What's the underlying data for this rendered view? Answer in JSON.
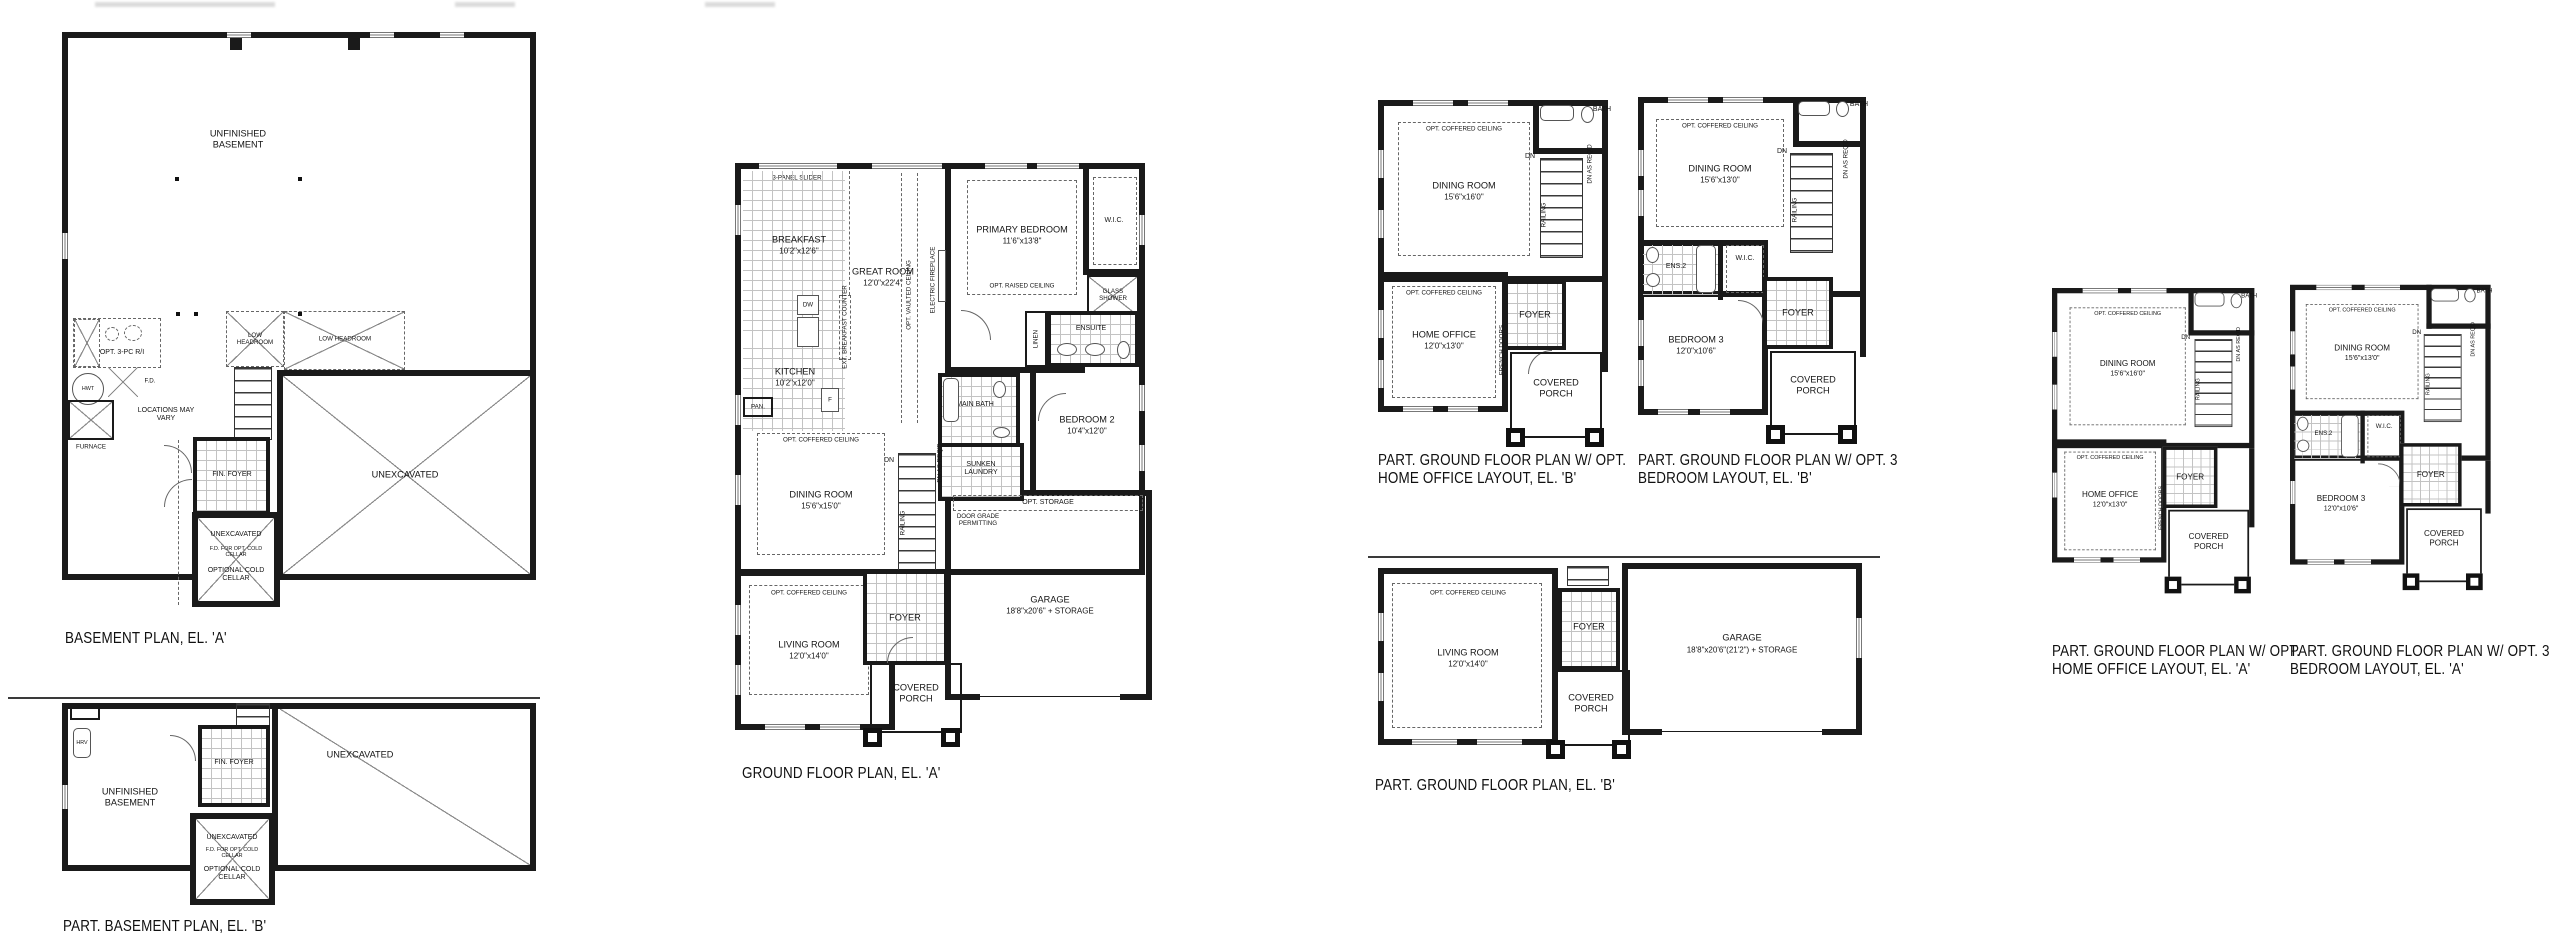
{
  "plans": {
    "basement_a": {
      "title": "BASEMENT PLAN, EL. 'A'",
      "labels": {
        "unfinished_basement": "UNFINISHED BASEMENT",
        "opt_3pc": "OPT. 3-PC R/I",
        "hwt": "HWT",
        "fd": "F.D.",
        "furnace": "FURNACE",
        "locations_vary": "LOCATIONS MAY VARY",
        "low_headroom_a": "LOW HEADROOM",
        "low_headroom_b": "LOW HEADROOM",
        "up": "UP",
        "fin_foyer": "FIN. FOYER",
        "unexcavated": "UNEXCAVATED",
        "cc_unexcavated": "UNEXCAVATED",
        "cc_fd": "F.D. FOR OPT. COLD CELLAR",
        "cold_cellar": "OPTIONAL COLD CELLAR"
      }
    },
    "basement_b": {
      "title": "PART. BASEMENT PLAN, EL. 'B'",
      "labels": {
        "unfinished_basement": "UNFINISHED BASEMENT",
        "hrv": "HRV",
        "fin_foyer": "FIN. FOYER",
        "up": "UP",
        "unexcavated": "UNEXCAVATED",
        "cc_unexcavated": "UNEXCAVATED",
        "cc_fd": "F.D. FOR OPT. COLD CELLAR",
        "cold_cellar": "OPTIONAL COLD CELLAR"
      }
    },
    "ground_a": {
      "title": "GROUND FLOOR PLAN, EL. 'A'",
      "labels": {
        "slider": "3-PANEL SLIDER",
        "breakfast": "BREAKFAST",
        "breakfast_dim": "10'2\"x12'6\"",
        "great_room": "GREAT ROOM",
        "great_room_dim": "12'0\"x22'4\"",
        "opt_vaulted": "OPT. VAULTED CEILING",
        "electric_fireplace": "ELECTRIC FIREPLACE",
        "primary_bedroom": "PRIMARY BEDROOM",
        "primary_dim": "11'6\"x13'8\"",
        "opt_raised": "OPT. RAISED CEILING",
        "wic": "W.I.C.",
        "glass_shower": "GLASS SHOWER",
        "ensuite": "ENSUITE",
        "linen": "LINEN",
        "kitchen": "KITCHEN",
        "kitchen_dim": "10'2\"x12'0\"",
        "pantry": "PAN.",
        "dw": "DW",
        "fridge": "F",
        "ext_counter": "EXT. BREAKFAST COUNTER",
        "main_bath": "MAIN BATH",
        "sunken_laundry": "SUNKEN LAUNDRY",
        "dn": "DN",
        "railing": "RAILING",
        "dn_as_reqd": "DN AS REQ'D",
        "opt_coffered_dining": "OPT. COFFERED CEILING",
        "dining": "DINING ROOM",
        "dining_dim": "15'6\"x15'0\"",
        "bedroom2": "BEDROOM 2",
        "bedroom2_dim": "10'4\"x12'0\"",
        "door_grade": "DOOR GRADE PERMITTING",
        "opt_storage": "OPT. STORAGE",
        "garage": "GARAGE",
        "garage_dim": "18'8\"x20'6\" + STORAGE",
        "opt_coffered_living": "OPT. COFFERED CEILING",
        "living": "LIVING ROOM",
        "living_dim": "12'0\"x14'0\"",
        "foyer": "FOYER",
        "covered_porch": "COVERED PORCH"
      }
    },
    "part_b_office": {
      "title_line1": "PART. GROUND FLOOR PLAN W/ OPT.",
      "title_line2": "HOME OFFICE LAYOUT, EL. 'B'",
      "labels": {
        "bath": "BATH",
        "opt_coffered_dining": "OPT. COFFERED CEILING",
        "dining": "DINING ROOM",
        "dining_dim": "15'6\"x16'0\"",
        "dn": "DN",
        "railing": "RAILING",
        "dn_as_reqd": "DN AS REQ'D",
        "opt_coffered_office": "OPT. COFFERED CEILING",
        "home_office": "HOME OFFICE",
        "home_office_dim": "12'0\"x13'0\"",
        "french_doors": "FRENCH DOORS",
        "foyer": "FOYER",
        "covered_porch": "COVERED PORCH"
      }
    },
    "part_b_bed3": {
      "title_line1": "PART. GROUND FLOOR PLAN W/ OPT. 3",
      "title_line2": "BEDROOM LAYOUT, EL. 'B'",
      "labels": {
        "bath": "BATH",
        "opt_coffered_dining": "OPT. COFFERED CEILING",
        "dining": "DINING ROOM",
        "dining_dim": "15'6\"x13'0\"",
        "ens2": "ENS.2",
        "wic": "W.I.C.",
        "bedroom3": "BEDROOM 3",
        "bedroom3_dim": "12'0\"x10'6\"",
        "dn": "DN",
        "railing": "RAILING",
        "dn_as_reqd": "DN AS REQ'D",
        "foyer": "FOYER",
        "covered_porch": "COVERED PORCH"
      }
    },
    "part_b_ground": {
      "title": "PART. GROUND FLOOR PLAN, EL. 'B'",
      "labels": {
        "opt_coffered_living": "OPT. COFFERED CEILING",
        "living": "LIVING ROOM",
        "living_dim": "12'0\"x14'0\"",
        "foyer": "FOYER",
        "garage": "GARAGE",
        "garage_dim": "18'8\"x20'6\"(21'2\") + STORAGE",
        "covered_porch": "COVERED PORCH"
      }
    },
    "part_a_office": {
      "title_line1": "PART. GROUND FLOOR PLAN W/ OPT.",
      "title_line2": "HOME OFFICE LAYOUT, EL. 'A'",
      "labels": {
        "bath": "BATH",
        "opt_coffered_dining": "OPT. COFFERED CEILING",
        "dining": "DINING ROOM",
        "dining_dim": "15'6\"x16'0\"",
        "dn": "DN",
        "railing": "RAILING",
        "dn_as_reqd": "DN AS REQ'D",
        "opt_coffered_office": "OPT. COFFERED CEILING",
        "home_office": "HOME OFFICE",
        "home_office_dim": "12'0\"x13'0\"",
        "french_doors": "FRENCH DOORS",
        "foyer": "FOYER",
        "covered_porch": "COVERED PORCH"
      }
    },
    "part_a_bed3": {
      "title_line1": "PART. GROUND FLOOR PLAN W/ OPT. 3",
      "title_line2": "BEDROOM LAYOUT, EL. 'A'",
      "labels": {
        "bath": "BATH",
        "opt_coffered_dining": "OPT. COFFERED CEILING",
        "dining": "DINING ROOM",
        "dining_dim": "15'6\"x13'0\"",
        "ens2": "ENS.2",
        "wic": "W.I.C.",
        "bedroom3": "BEDROOM 3",
        "bedroom3_dim": "12'0\"x10'6\"",
        "dn": "DN",
        "railing": "RAILING",
        "dn_as_reqd": "DN AS REQ'D",
        "foyer": "FOYER",
        "covered_porch": "COVERED PORCH"
      }
    }
  }
}
